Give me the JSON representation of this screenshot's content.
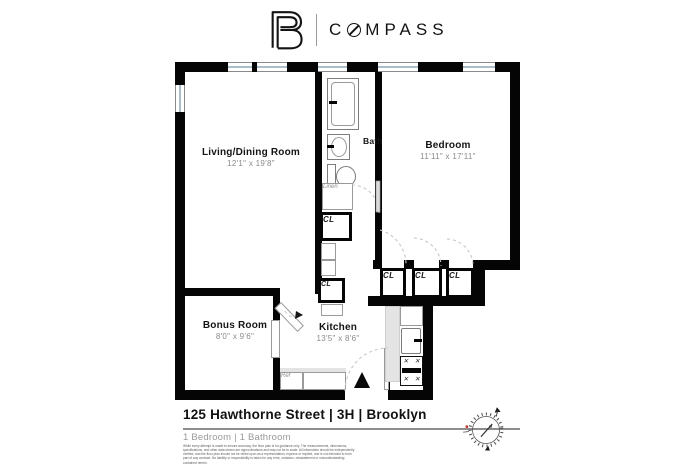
{
  "header": {
    "brand": {
      "full": "COMPASS",
      "before_o": "C",
      "after_o": "MPASS"
    },
    "icons": {
      "logo_monogram": "compass-monogram-icon",
      "wordmark_o": "slashed-o-icon"
    }
  },
  "floorplan": {
    "rooms": [
      {
        "name": "Living/Dining Room",
        "dims": "12'1\" x 19'8\""
      },
      {
        "name": "Bedroom",
        "dims": "11'11\" x 17'11\""
      },
      {
        "name": "Bath",
        "dims": ""
      },
      {
        "name": "Kitchen",
        "dims": "13'5\" x 8'6\""
      },
      {
        "name": "Bonus Room",
        "dims": "8'0\" x 9'6\""
      }
    ],
    "labels": {
      "closet": "CL",
      "linen": "Linen",
      "refrigerator": "Ref"
    },
    "icons": {
      "entry_marker": "entry-triangle-icon",
      "north_indicator": "compass-rose-icon"
    }
  },
  "footer": {
    "address": "125 Hawthorne Street | 3H | Brooklyn",
    "summary": "1 Bedroom | 1 Bathroom",
    "disclaimer": "While every attempt is made to ensure accuracy, the floor plan is for guidance only. The measurements, dimensions, specifications, and other data shown are approximations and may not be to scale. All information should be independently verified, and the floor plan should not be relied upon as a representation, express or implied, and is not intended to form part of any contract. No liability or responsibility is taken for any error, omission, misstatement or misunderstanding contained herein."
  },
  "colors": {
    "wall": "#050505",
    "window_glass": "#a9bec8",
    "dim_text": "#8a8a8a",
    "accent_red": "#c0392b"
  }
}
